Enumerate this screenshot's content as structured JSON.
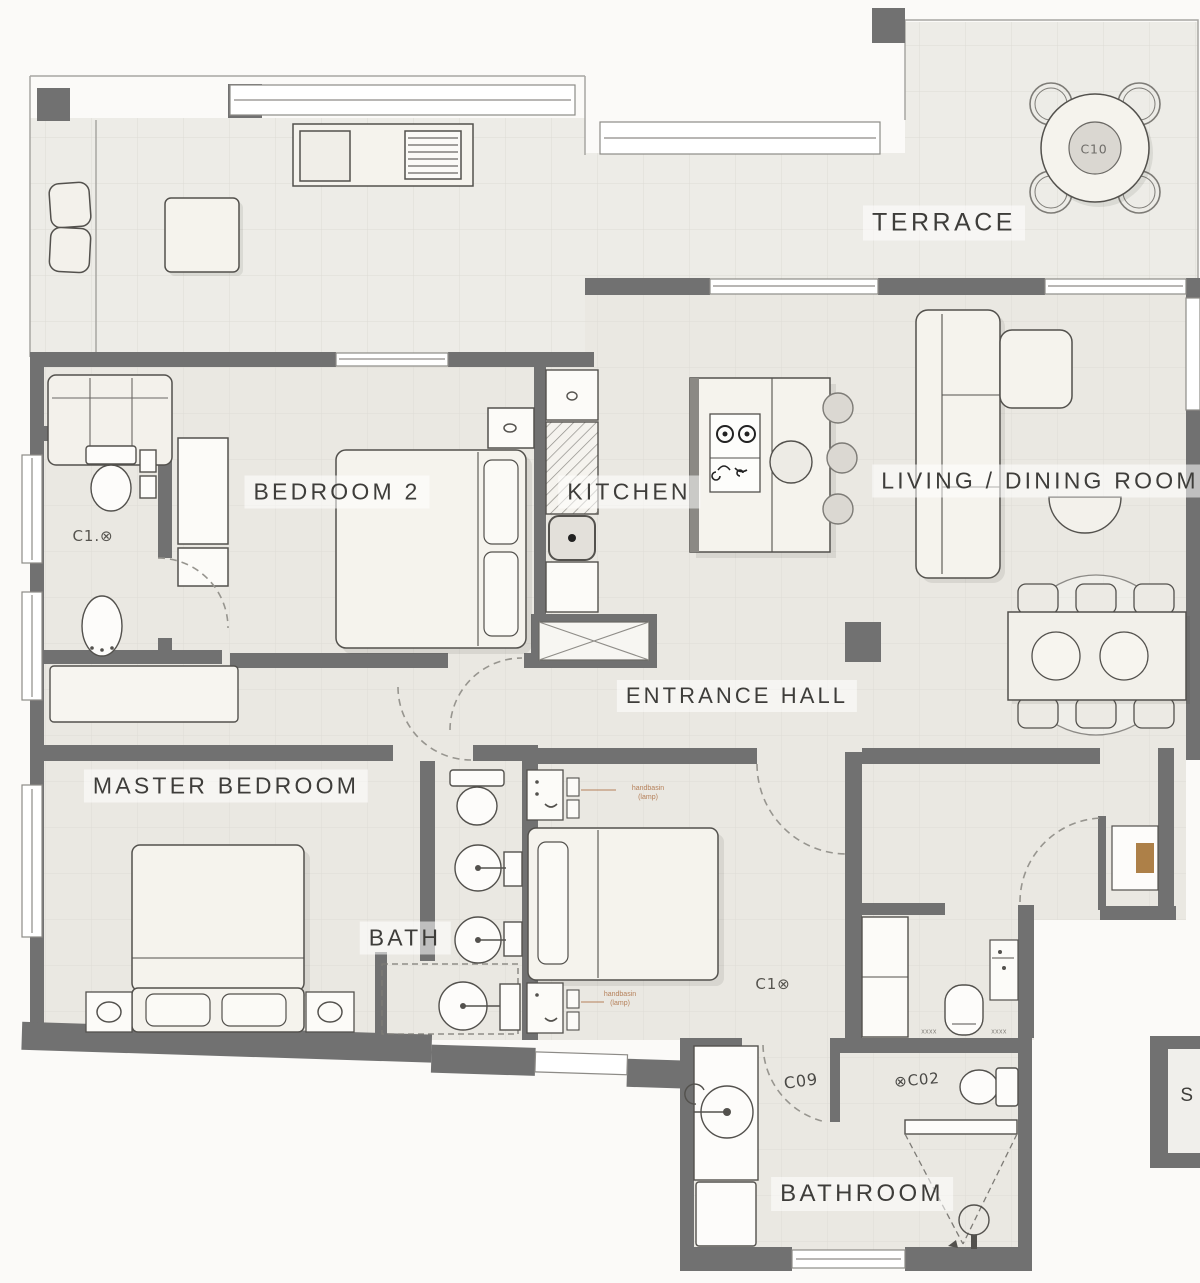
{
  "rooms": {
    "terrace": "TERRACE",
    "bedroom2": "BEDROOM 2",
    "kitchen": "KITCHEN",
    "living": "LIVING / DINING ROOM",
    "entrance": "ENTRANCE HALL",
    "master": "MASTER BEDROOM",
    "bath": "BATH",
    "bathroom": "BATHROOM",
    "stair": "S"
  },
  "markers": {
    "table": "C10",
    "wc": "C1.⊗",
    "bedroom3": "C1⊗",
    "c09": "C09",
    "c02": "⊗C02"
  },
  "annotations": {
    "handbasin_line1": "handbasin",
    "handbasin_line2": "(lamp)",
    "threshold": "xxxx"
  },
  "colors": {
    "wall": "#717171",
    "floor": "#eae8e2",
    "terrace_floor": "#edece7",
    "outside": "#fbfaf8",
    "furniture": "#f3f1eb",
    "label_text": "#3e3d3a",
    "annotation_text": "#b5805a",
    "accent_brown": "#ad8048"
  }
}
